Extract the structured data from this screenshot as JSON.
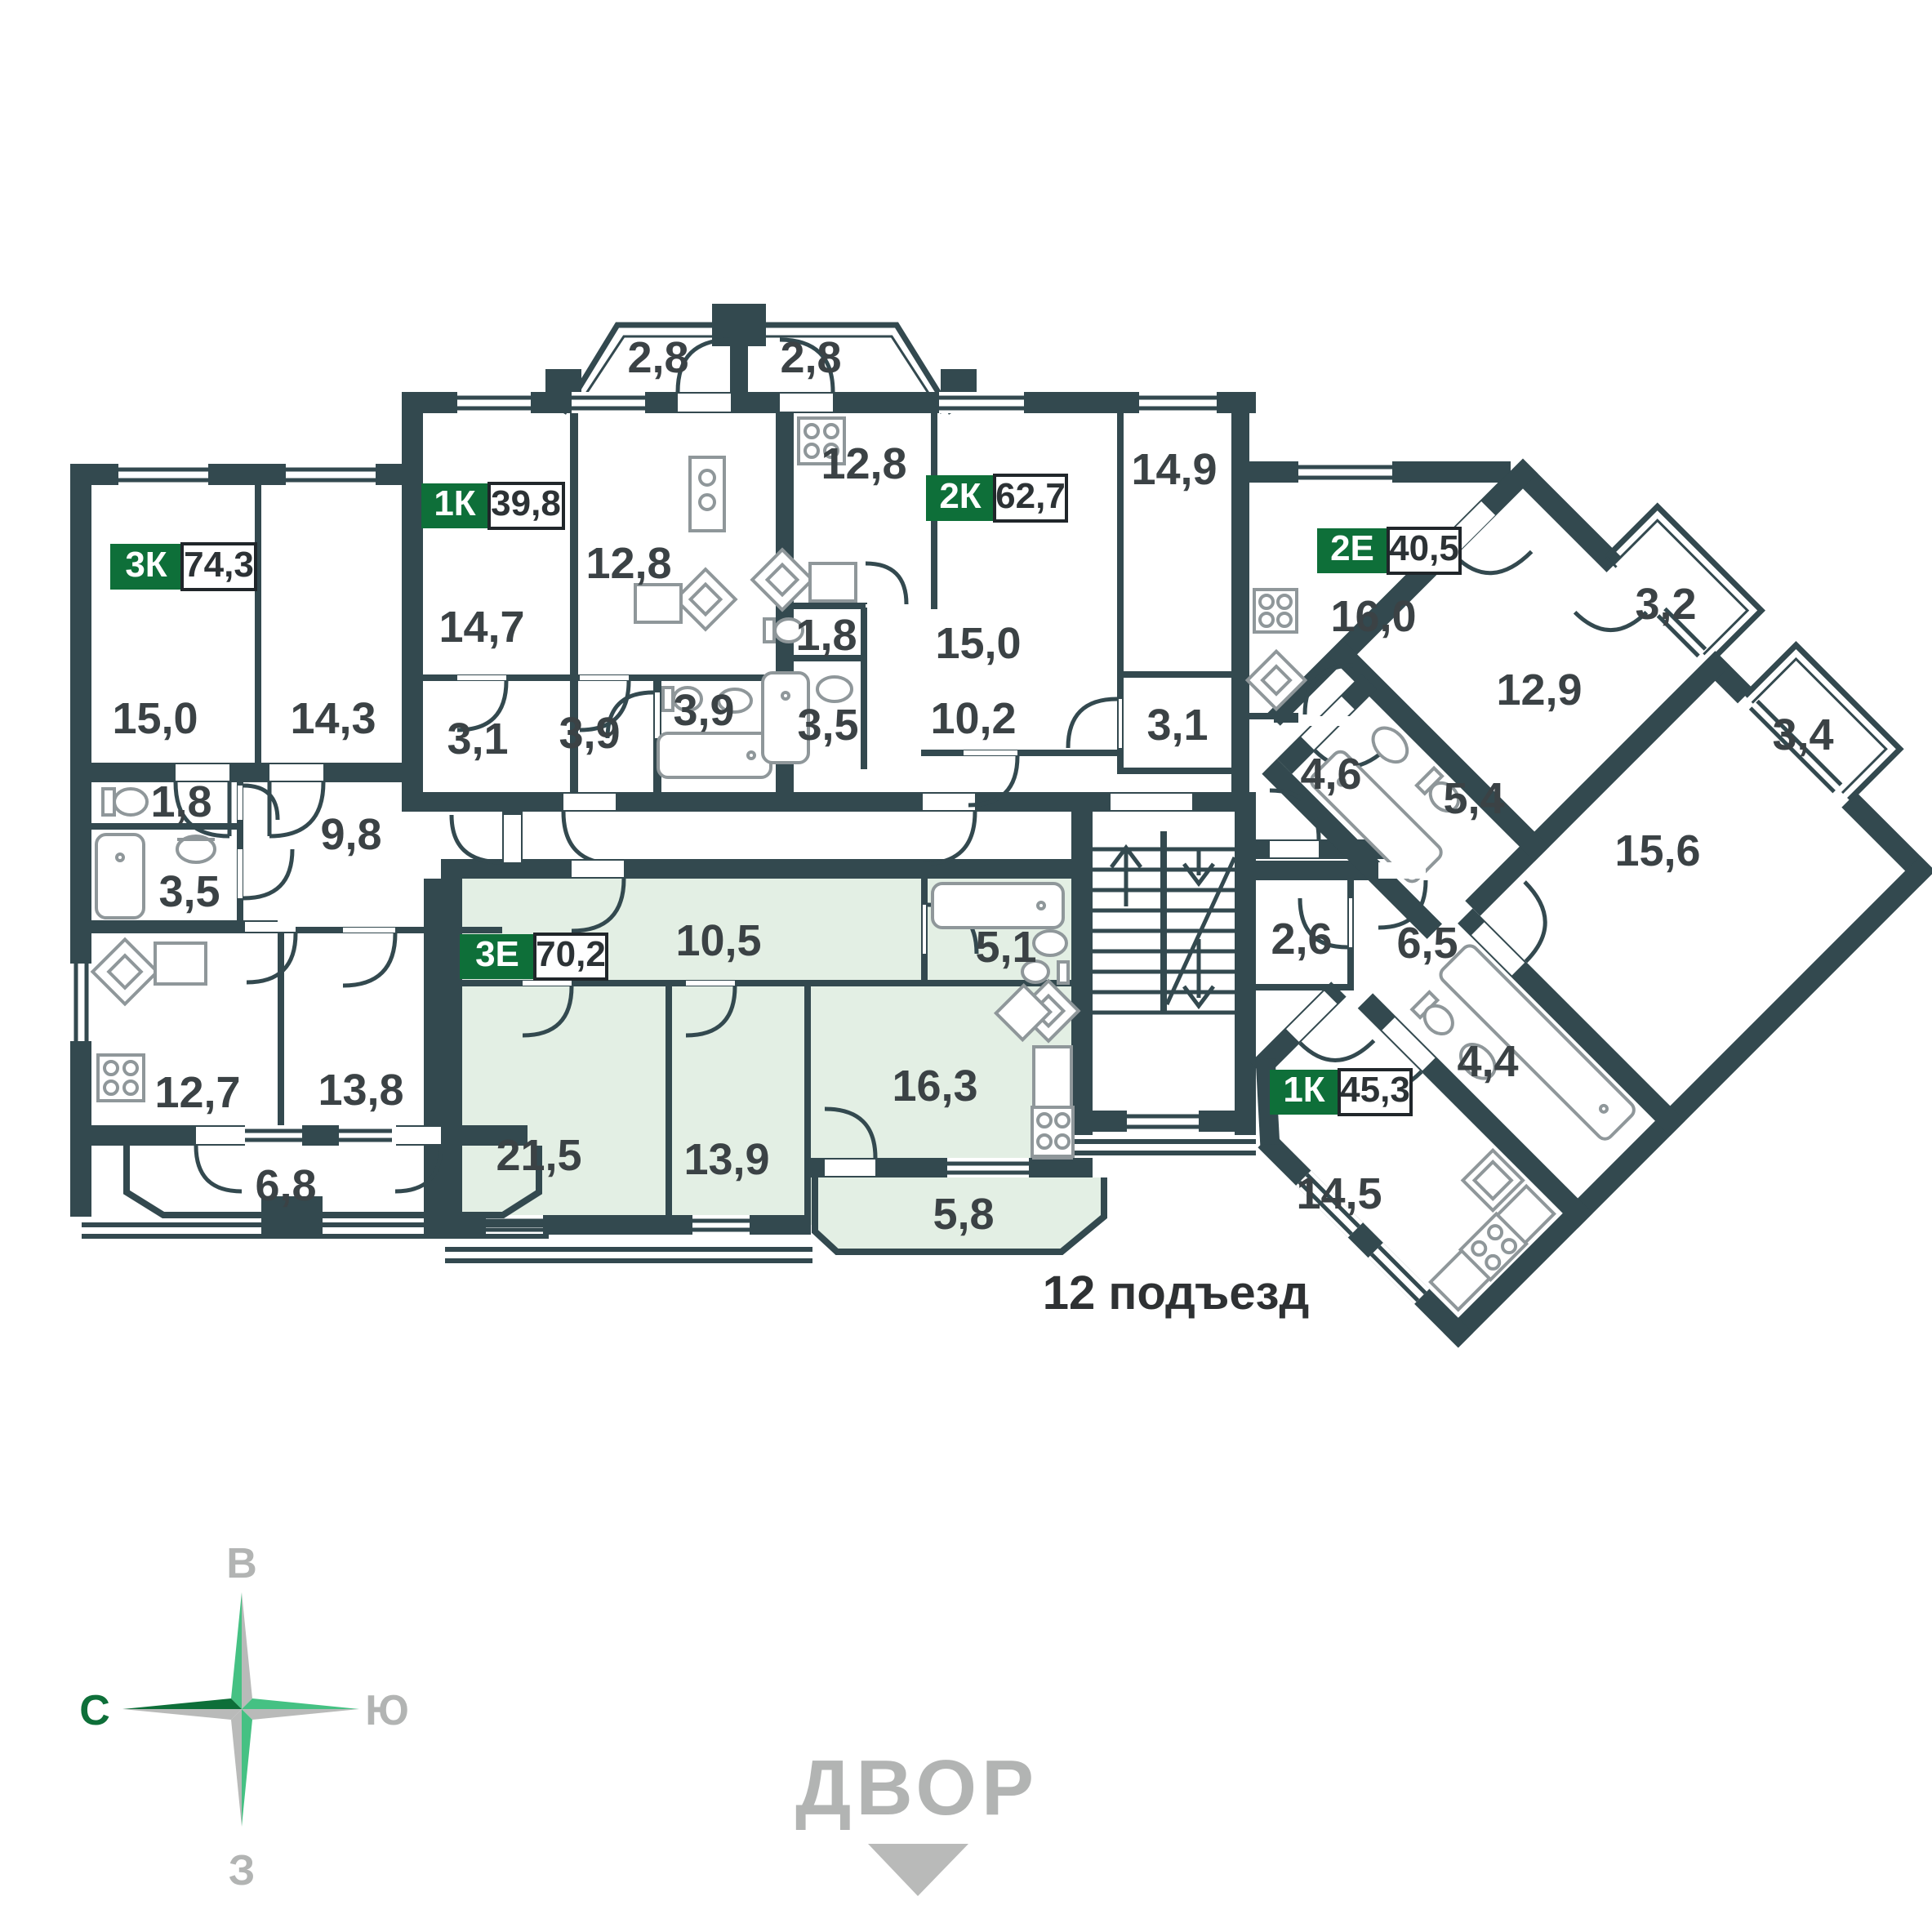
{
  "colors": {
    "wall": "#33494f",
    "accent": "#0e6f39",
    "highlight": "#e3efe4",
    "gray": "#b2b4b3",
    "text": "#3b4245",
    "fixture": "#8f979a"
  },
  "entrance": {
    "label": "12 подъезд"
  },
  "courtyard": {
    "label": "ДВОР"
  },
  "compass": {
    "east": "В",
    "north": "С",
    "south": "Ю",
    "west": "З"
  },
  "apartments": [
    {
      "code": "3К",
      "area": "74,3",
      "highlighted": false
    },
    {
      "code": "1К",
      "area": "39,8",
      "highlighted": false
    },
    {
      "code": "2К",
      "area": "62,7",
      "highlighted": false
    },
    {
      "code": "2Е",
      "area": "40,5",
      "highlighted": false
    },
    {
      "code": "3Е",
      "area": "70,2",
      "highlighted": true
    },
    {
      "code": "1К",
      "area": "45,3",
      "highlighted": false
    }
  ],
  "rooms": [
    {
      "label": "15,0"
    },
    {
      "label": "14,3"
    },
    {
      "label": "1,8"
    },
    {
      "label": "3,5"
    },
    {
      "label": "9,8"
    },
    {
      "label": "12,7"
    },
    {
      "label": "13,8"
    },
    {
      "label": "6,8"
    },
    {
      "label": "14,7"
    },
    {
      "label": "12,8"
    },
    {
      "label": "3,1"
    },
    {
      "label": "3,9"
    },
    {
      "label": "3,9"
    },
    {
      "label": "2,8"
    },
    {
      "label": "2,8"
    },
    {
      "label": "12,8"
    },
    {
      "label": "15,0"
    },
    {
      "label": "14,9"
    },
    {
      "label": "1,8"
    },
    {
      "label": "3,5"
    },
    {
      "label": "10,2"
    },
    {
      "label": "3,1"
    },
    {
      "label": "16,0"
    },
    {
      "label": "4,6"
    },
    {
      "label": "12,9"
    },
    {
      "label": "3,2"
    },
    {
      "label": "3,4"
    },
    {
      "label": "5,4"
    },
    {
      "label": "15,6"
    },
    {
      "label": "2,6"
    },
    {
      "label": "6,5"
    },
    {
      "label": "4,4"
    },
    {
      "label": "14,5"
    },
    {
      "label": "10,5"
    },
    {
      "label": "5,1"
    },
    {
      "label": "21,5"
    },
    {
      "label": "13,9"
    },
    {
      "label": "16,3"
    },
    {
      "label": "5,8"
    }
  ]
}
